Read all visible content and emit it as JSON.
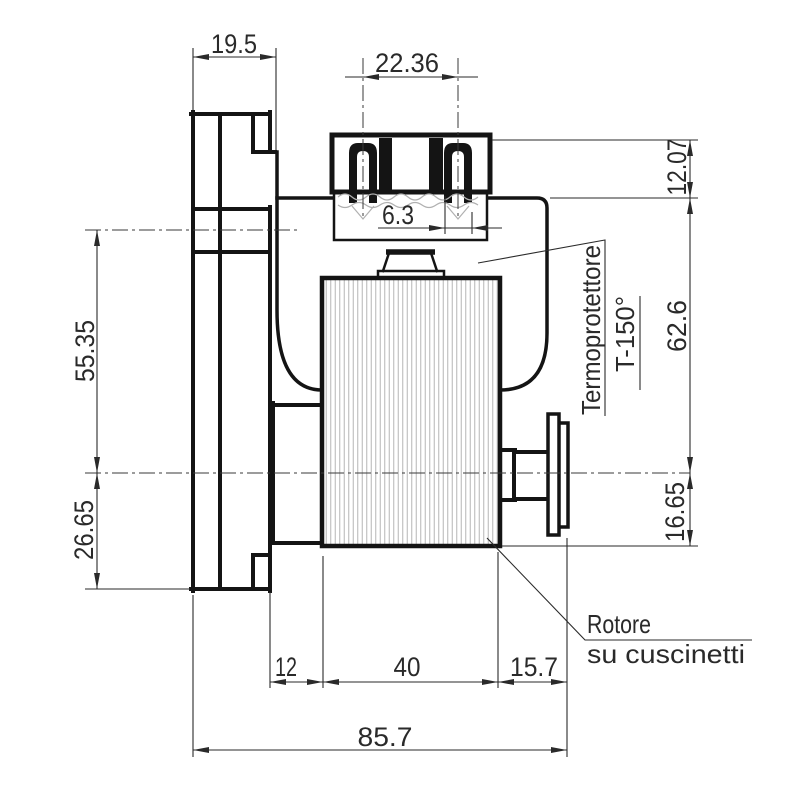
{
  "drawing": {
    "type": "technical-drawing",
    "subject": "gear motor side view with dimensions",
    "colors": {
      "line": "#141414",
      "thin_line": "#2a2a2a",
      "hatch": "#b5b5b5",
      "background": "#ffffff"
    },
    "dims": {
      "d19_5": "19.5",
      "d22_36": "22.36",
      "d6_3": "6.3",
      "d12_07": "12.07",
      "d62_6": "62.6",
      "d16_65": "16.65",
      "d55_35": "55.35",
      "d26_65": "26.65",
      "d12": "12",
      "d40": "40",
      "d15_7": "15.7",
      "d85_7": "85.7"
    },
    "labels": {
      "thermo1": "Termoprotettore",
      "thermo2": "T-150°",
      "rotor1": "Rotore",
      "rotor2": "su cuscinetti"
    }
  }
}
